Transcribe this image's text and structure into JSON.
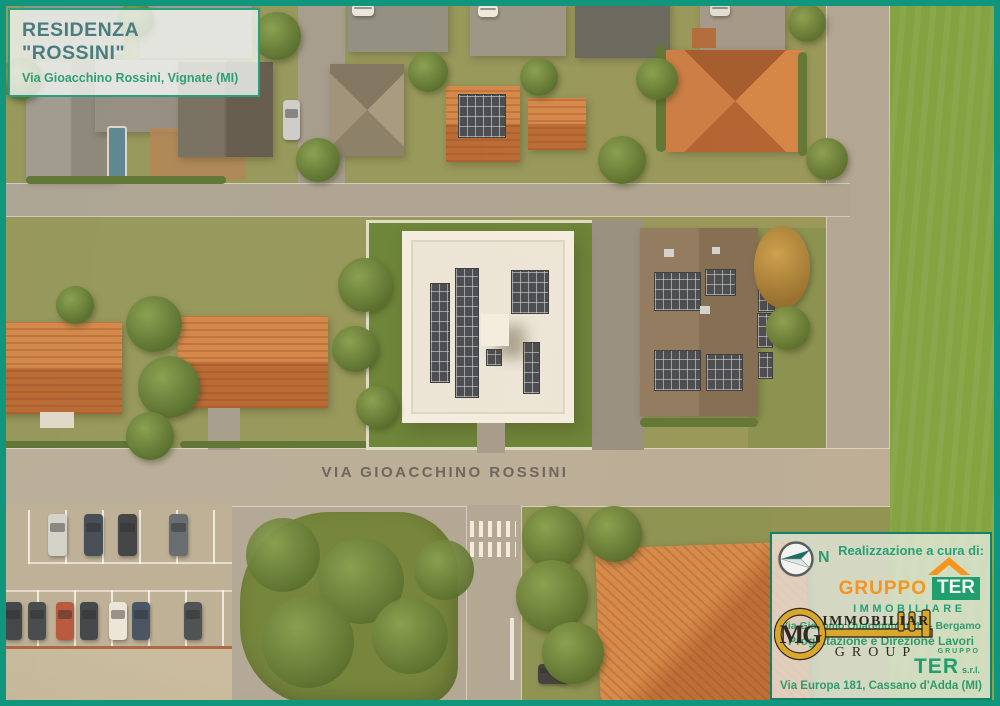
{
  "title_box": {
    "title": "RESIDENZA \"ROSSINI\"",
    "subtitle": "Via Gioacchino Rossini, Vignate (MI)"
  },
  "street_label": "VIA GIOACCHINO ROSSINI",
  "credits": {
    "heading": "Realizzazione a cura di:",
    "compass_label": "N",
    "gruppo_ter": {
      "name_part1": "GRUPPO",
      "name_part2": "TER",
      "tagline": "IMMOBILIARE",
      "address": "Via Giacomo Quarenghi n. 11 - Bergamo"
    },
    "mg_group": {
      "monogram": "MG",
      "word_top": "IMMOBILIAR",
      "word_bottom": "GROUP",
      "role_line": "Progettazione e Direzione Lavori"
    },
    "ter_srl": {
      "small_word": "GRUPPO",
      "name": "TER",
      "suffix": "s.r.l.",
      "address": "Via Europa 181, Cassano d'Adda (MI)"
    }
  },
  "colors": {
    "frame_teal": "#11967e",
    "text_green": "#2f9b6d",
    "brand_orange": "#f5941f",
    "ter_green": "#1f9e6e",
    "key_gold": "#d9a72e",
    "title_teal": "#497d80",
    "road_gray": "#a7a195",
    "lawn_green": "#5a7b2d",
    "field_green": "#6f9d37"
  },
  "icons": {
    "compass": "north-compass-icon",
    "gruppo_ter_roof": "roof-icon",
    "mg_key": "key-icon"
  }
}
